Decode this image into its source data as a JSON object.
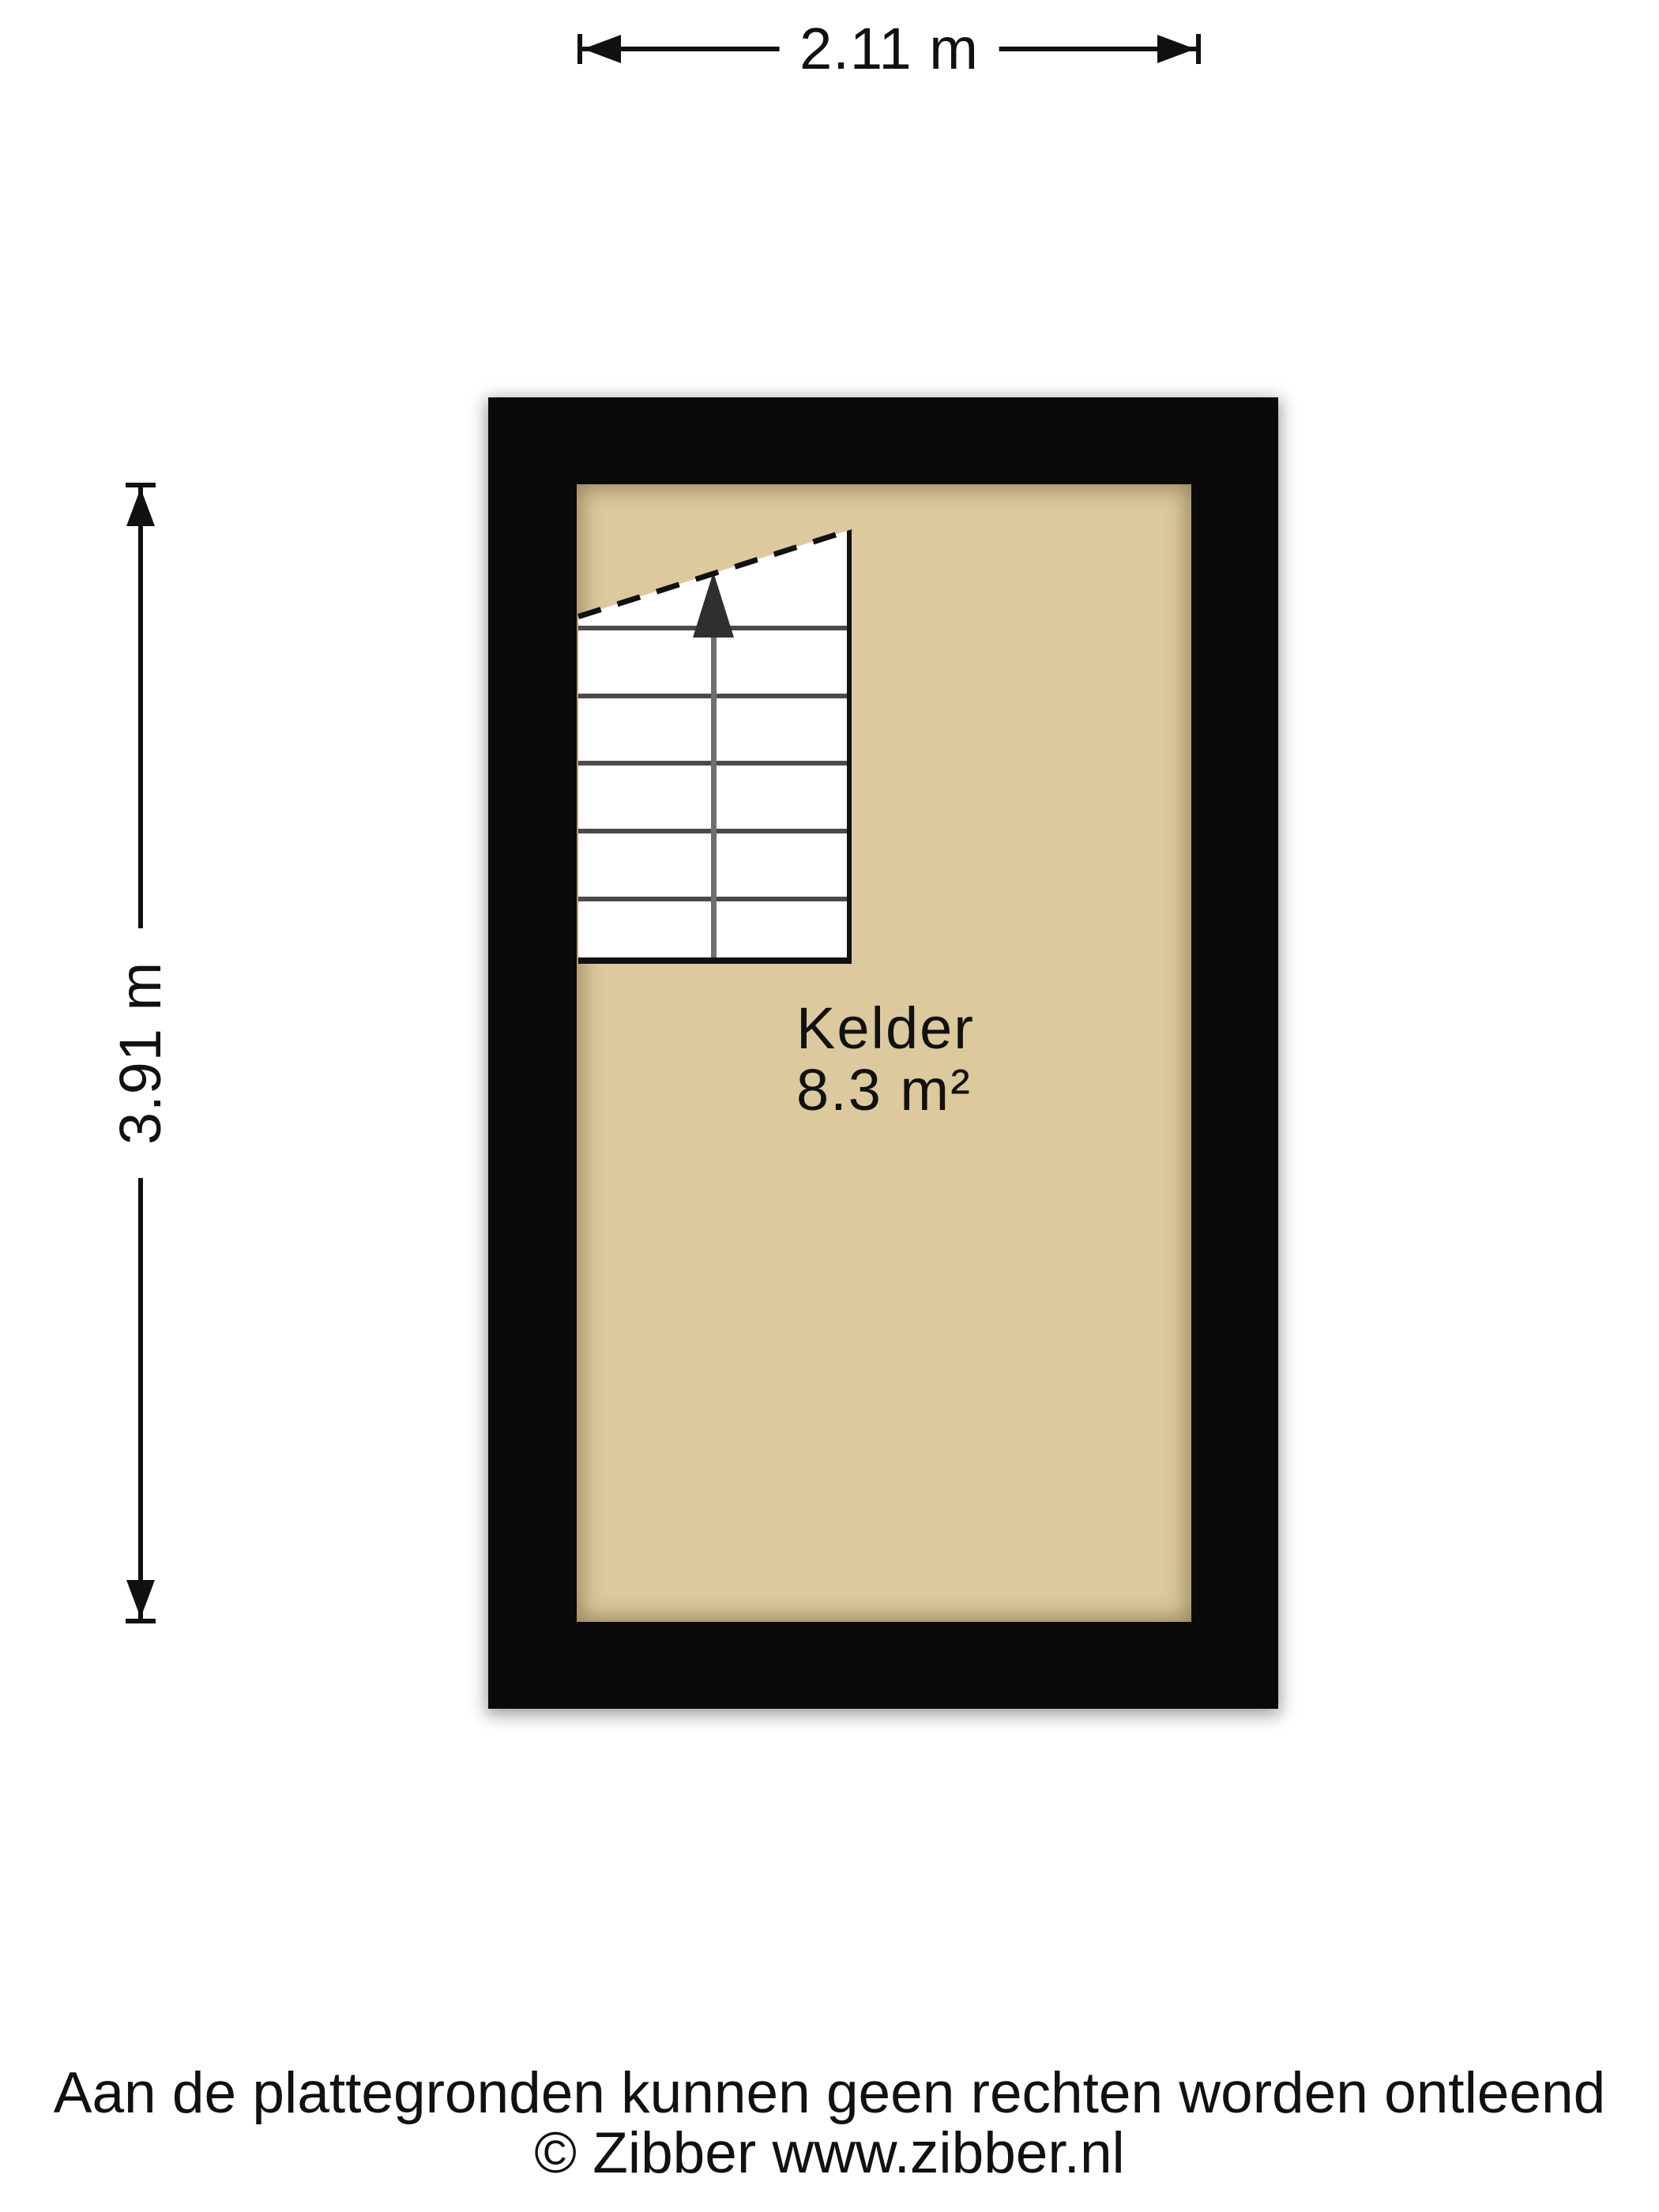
{
  "dimensions": {
    "width": {
      "label": "2.11 m"
    },
    "height": {
      "label": "3.91 m"
    }
  },
  "room": {
    "name": "Kelder",
    "area": "8.3 m²"
  },
  "stairs": {
    "direction": "up"
  },
  "footer": {
    "disclaimer": "Aan de plattegronden kunnen geen rechten worden ontleend",
    "copyright": "© Zibber www.zibber.nl"
  },
  "colors": {
    "wall": "#0a0a0a",
    "floor": "#dcc99d",
    "stair_fill": "#ffffff",
    "ink": "#111111",
    "tread": "#4a4a4a",
    "shaft": "#6f6f6f",
    "arrow": "#2f2f2f"
  }
}
